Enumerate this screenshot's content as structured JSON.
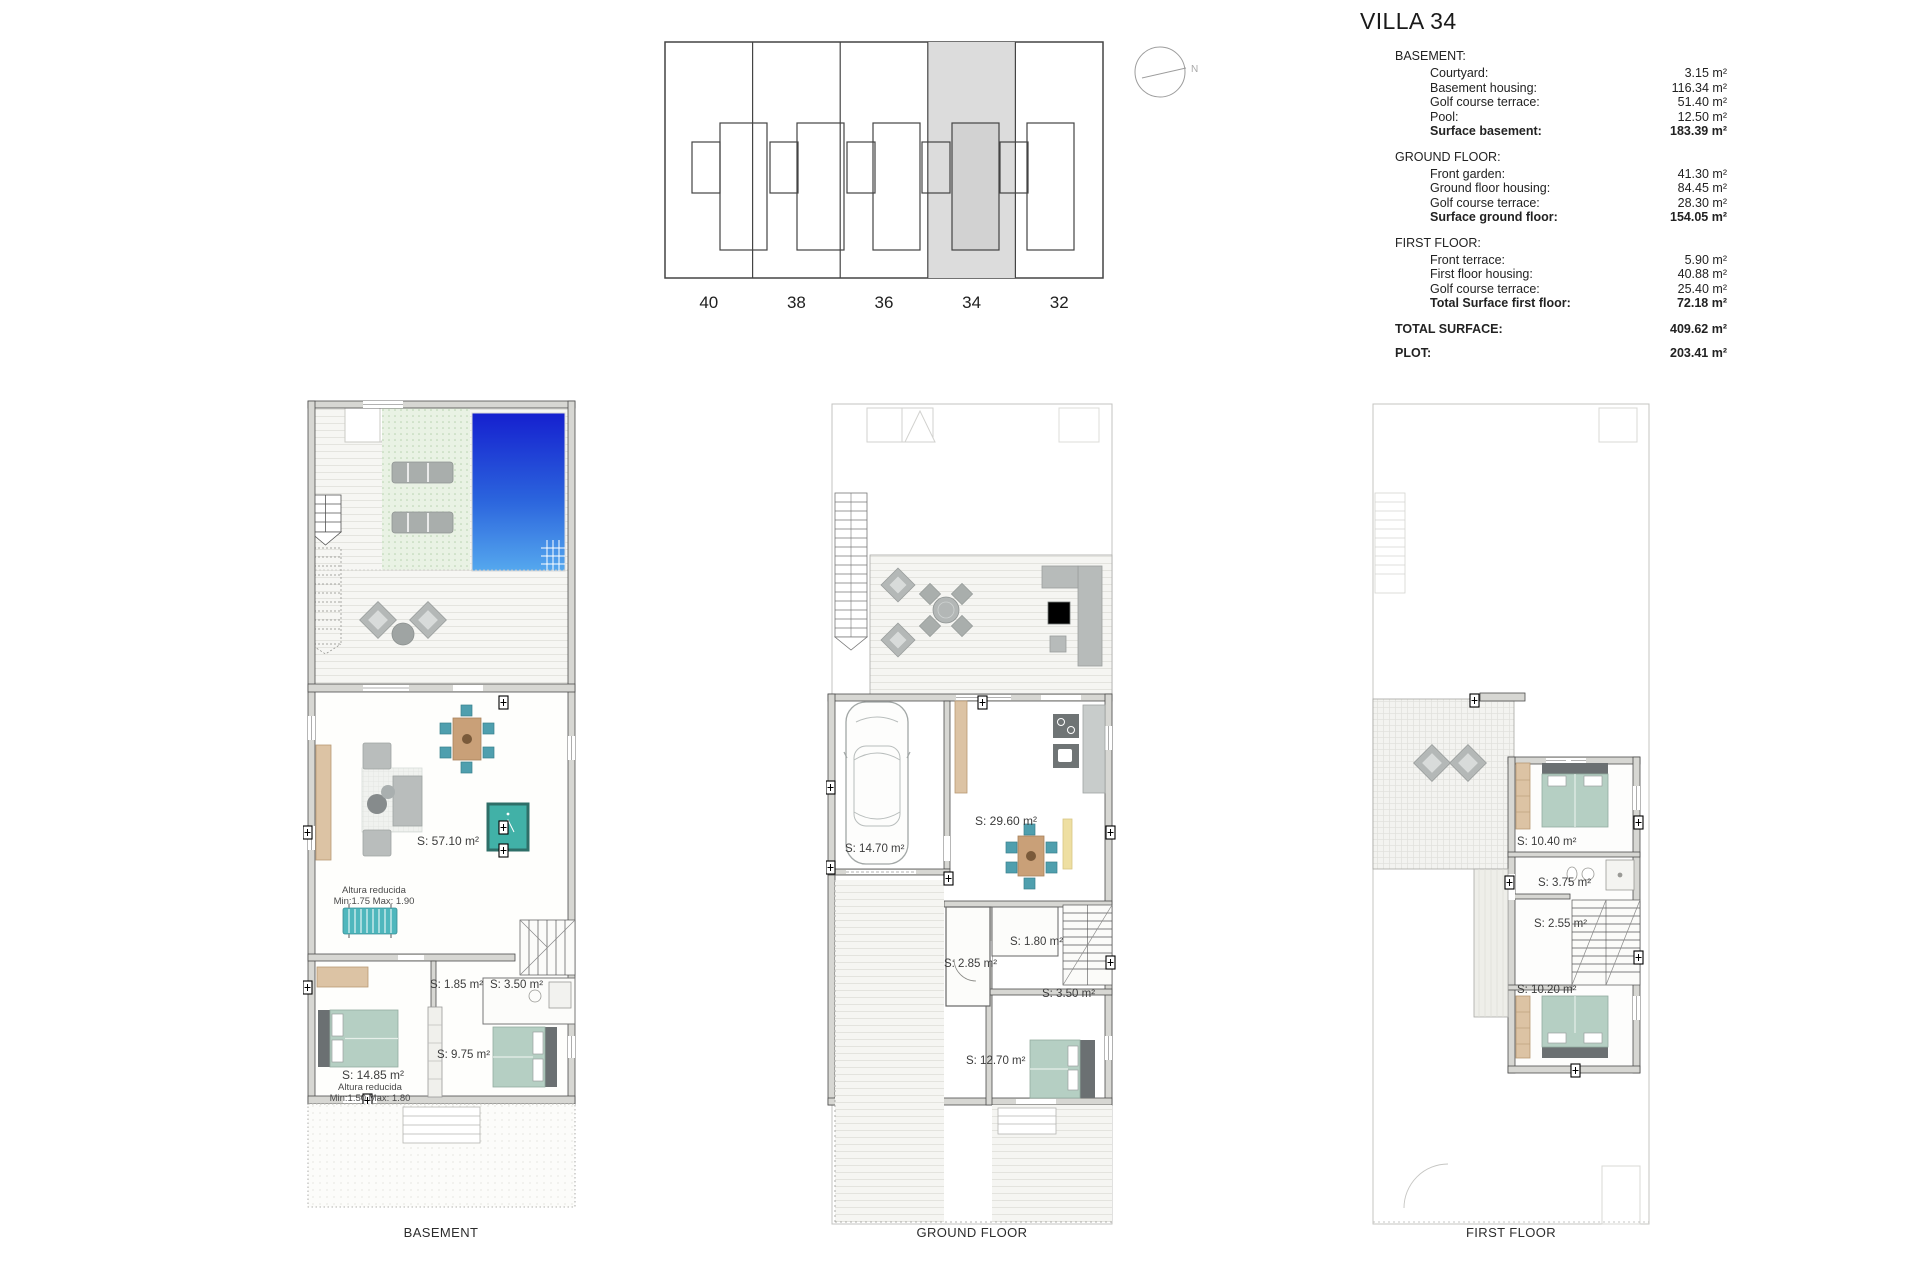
{
  "title": "VILLA 34",
  "compass": {
    "label": "N"
  },
  "site_plan": {
    "units": [
      "40",
      "38",
      "36",
      "34",
      "32"
    ],
    "highlighted_unit": "34"
  },
  "surface_table": {
    "sections": [
      {
        "header": "BASEMENT:",
        "rows": [
          {
            "label": "Courtyard:",
            "value": "3.15 m²"
          },
          {
            "label": "Basement housing:",
            "value": "116.34 m²"
          },
          {
            "label": "Golf course terrace:",
            "value": "51.40 m²"
          },
          {
            "label": "Pool:",
            "value": "12.50 m²"
          }
        ],
        "total": {
          "label": "Surface basement:",
          "value": "183.39 m²"
        }
      },
      {
        "header": "GROUND FLOOR:",
        "rows": [
          {
            "label": "Front garden:",
            "value": "41.30 m²"
          },
          {
            "label": "Ground floor housing:",
            "value": "84.45 m²"
          },
          {
            "label": "Golf course terrace:",
            "value": "28.30 m²"
          }
        ],
        "total": {
          "label": "Surface ground floor:",
          "value": "154.05 m²"
        }
      },
      {
        "header": "FIRST FLOOR:",
        "rows": [
          {
            "label": "Front terrace:",
            "value": "5.90 m²"
          },
          {
            "label": "First floor housing:",
            "value": "40.88 m²"
          },
          {
            "label": "Golf course terrace:",
            "value": "25.40 m²"
          }
        ],
        "total": {
          "label": "Total Surface first floor:",
          "value": "72.18 m²"
        }
      }
    ],
    "summary": [
      {
        "label": "TOTAL SURFACE:",
        "value": "409.62 m²"
      },
      {
        "label": "PLOT:",
        "value": "203.41 m²"
      }
    ]
  },
  "plans": {
    "basement": {
      "caption": "BASEMENT",
      "labels": {
        "living": "S: 57.10 m²",
        "altura1_line1": "Altura reducida",
        "altura1_line2": "Min:1.75 Max: 1.90",
        "storage": "S: 1.85 m²",
        "bath": "S: 3.50 m²",
        "hall": "S: 9.75 m²",
        "bedroom": "S: 14.85 m²",
        "altura2_line1": "Altura reducida",
        "altura2_line2": "Min:1.50 Max: 1.80"
      }
    },
    "ground": {
      "caption": "GROUND FLOOR",
      "labels": {
        "living": "S: 29.60 m²",
        "garage": "S: 14.70 m²",
        "toilet": "S: 1.80 m²",
        "hall": "S: 2.85 m²",
        "bath": "S: 3.50 m²",
        "bedroom": "S: 12.70 m²"
      }
    },
    "first": {
      "caption": "FIRST FLOOR",
      "labels": {
        "bedroom1": "S: 10.40 m²",
        "bath": "S: 3.75 m²",
        "landing": "S: 2.55 m²",
        "bedroom2": "S: 10.20 m²"
      }
    }
  },
  "colors": {
    "pool_top": "#1520cf",
    "pool_bottom": "#55a8ee",
    "golf_terrace_green": "#e9f2e4",
    "bed_teal": "#b5cfc3",
    "chair_teal": "#4f9fae",
    "wood_tan": "#dcc3a4",
    "wall_gray": "#d7d7d3",
    "highlight_unit_gray": "#dcdcdc"
  }
}
